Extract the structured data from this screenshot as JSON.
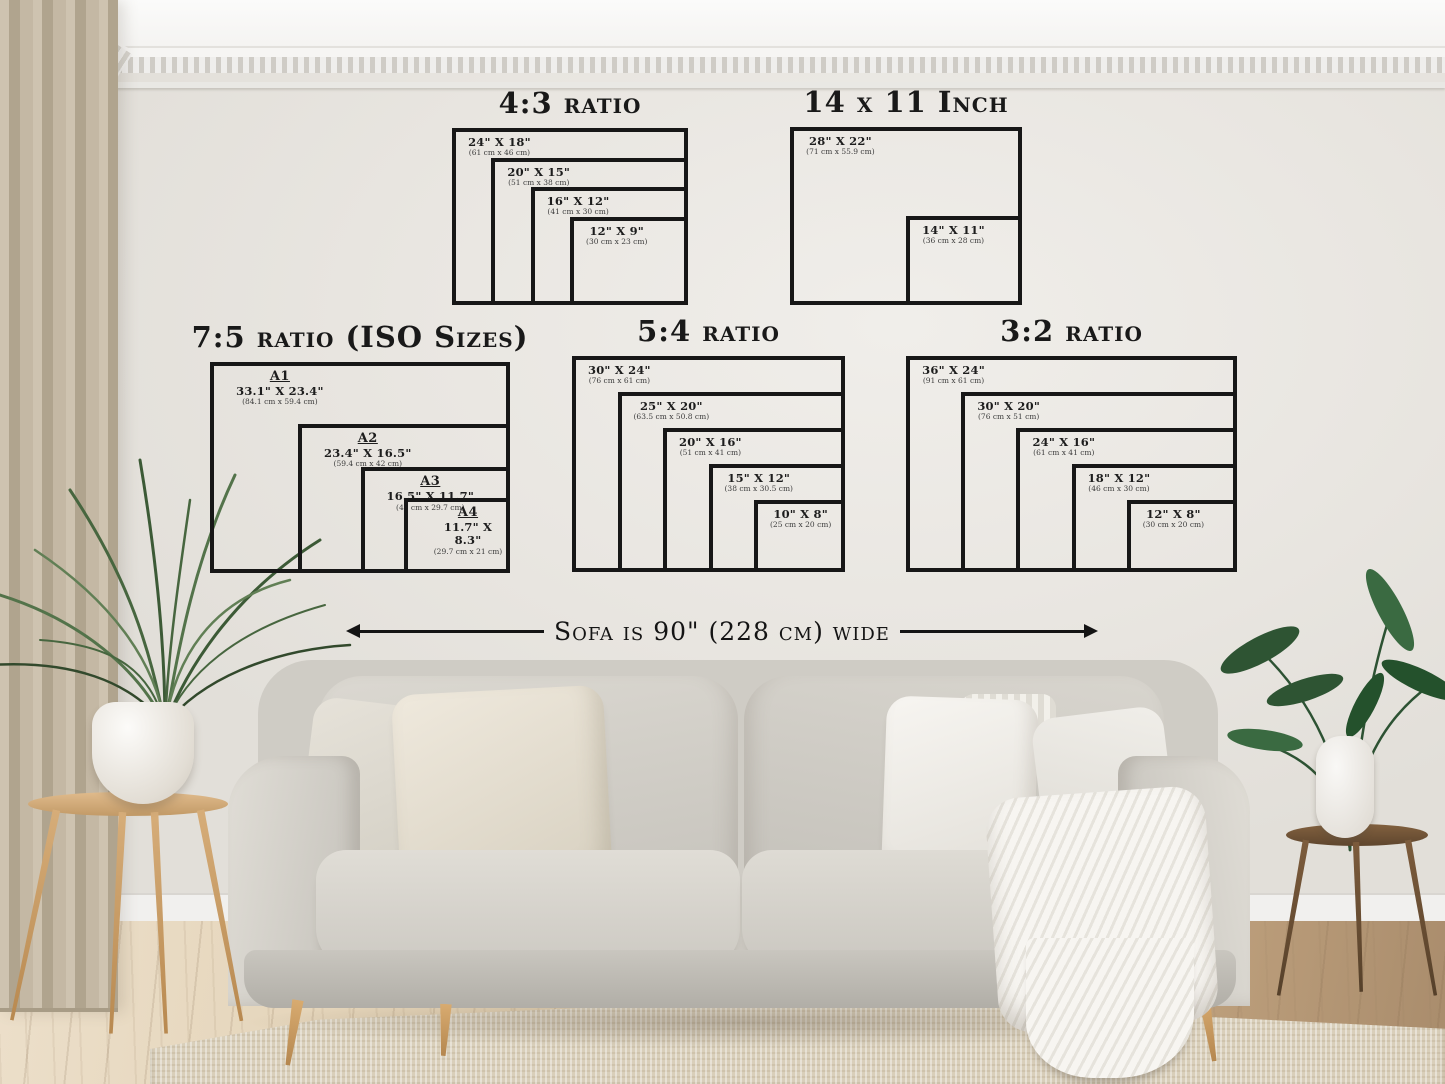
{
  "scene": {
    "sofa_note": "Sofa is 90\" (228 cm) wide"
  },
  "groups": [
    {
      "id": "4-3",
      "title": "4:3 ratio",
      "sizes": [
        {
          "label": "24\" x 18\"",
          "cm": "(61 cm x 46 cm)",
          "w_in": 24,
          "h_in": 18
        },
        {
          "label": "20\" x 15\"",
          "cm": "(51 cm x 38 cm)",
          "w_in": 20,
          "h_in": 15
        },
        {
          "label": "16\" x 12\"",
          "cm": "(41 cm x 30 cm)",
          "w_in": 16,
          "h_in": 12
        },
        {
          "label": "12\" x 9\"",
          "cm": "(30 cm x 23 cm)",
          "w_in": 12,
          "h_in": 9
        }
      ]
    },
    {
      "id": "14x11",
      "title": "14 x 11 Inch",
      "sizes": [
        {
          "label": "28\" x 22\"",
          "cm": "(71 cm x 55.9 cm)",
          "w_in": 28,
          "h_in": 22
        },
        {
          "label": "14\" x 11\"",
          "cm": "(36 cm x 28 cm)",
          "w_in": 14,
          "h_in": 11
        }
      ]
    },
    {
      "id": "7-5",
      "title": "7:5 ratio (ISO Sizes)",
      "sizes": [
        {
          "name": "A1",
          "label": "33.1\" x 23.4\"",
          "cm": "(84.1 cm x 59.4 cm)",
          "w_in": 33.1,
          "h_in": 23.4
        },
        {
          "name": "A2",
          "label": "23.4\" x 16.5\"",
          "cm": "(59.4 cm x 42 cm)",
          "w_in": 23.4,
          "h_in": 16.5
        },
        {
          "name": "A3",
          "label": "16.5\" x 11.7\"",
          "cm": "(42 cm x 29.7 cm)",
          "w_in": 16.5,
          "h_in": 11.7
        },
        {
          "name": "A4",
          "label": "11.7\" x 8.3\"",
          "cm": "(29.7 cm x 21 cm)",
          "w_in": 11.7,
          "h_in": 8.3
        }
      ]
    },
    {
      "id": "5-4",
      "title": "5:4 ratio",
      "sizes": [
        {
          "label": "30\" x 24\"",
          "cm": "(76 cm x 61 cm)",
          "w_in": 30,
          "h_in": 24
        },
        {
          "label": "25\" x 20\"",
          "cm": "(63.5 cm x 50.8 cm)",
          "w_in": 25,
          "h_in": 20
        },
        {
          "label": "20\" x 16\"",
          "cm": "(51 cm x 41 cm)",
          "w_in": 20,
          "h_in": 16
        },
        {
          "label": "15\" x 12\"",
          "cm": "(38 cm x 30.5 cm)",
          "w_in": 15,
          "h_in": 12
        },
        {
          "label": "10\" x 8\"",
          "cm": "(25 cm x 20 cm)",
          "w_in": 10,
          "h_in": 8
        }
      ]
    },
    {
      "id": "3-2",
      "title": "3:2 ratio",
      "sizes": [
        {
          "label": "36\" x 24\"",
          "cm": "(91 cm x 61 cm)",
          "w_in": 36,
          "h_in": 24
        },
        {
          "label": "30\" x 20\"",
          "cm": "(76 cm x 51 cm)",
          "w_in": 30,
          "h_in": 20
        },
        {
          "label": "24\" x 16\"",
          "cm": "(61 cm x 41 cm)",
          "w_in": 24,
          "h_in": 16
        },
        {
          "label": "18\" x 12\"",
          "cm": "(46 cm x 30 cm)",
          "w_in": 18,
          "h_in": 12
        },
        {
          "label": "12\" x 8\"",
          "cm": "(30 cm x 20 cm)",
          "w_in": 12,
          "h_in": 8
        }
      ]
    }
  ],
  "colors": {
    "line": "#171717",
    "wall": "#e9e6e1",
    "sofa": "#d3d0c9",
    "wood_light": "#c89a62",
    "wood_dark": "#6f5138",
    "plant_green": "#47663f"
  }
}
